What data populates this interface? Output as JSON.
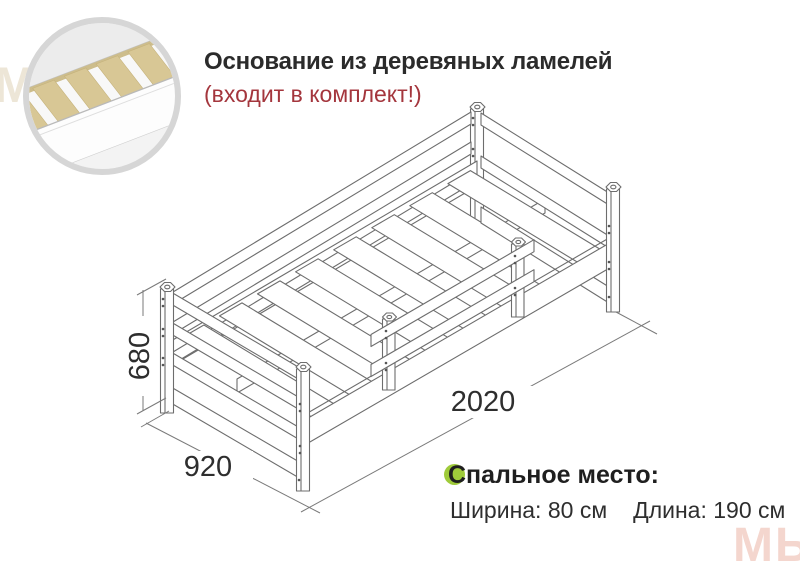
{
  "header": {
    "title": "Основание из деревяных ламелей",
    "subtitle": "(входит в комплект!)",
    "title_color": "#2b2b2b",
    "subtitle_color": "#a4363d"
  },
  "dimensions": {
    "height": "680",
    "width": "920",
    "length": "2020",
    "line_color": "#7a7a7a",
    "label_color": "#2e2e2e"
  },
  "sleeping_area": {
    "heading": "Спальное место:",
    "width_text": "Ширина: 80 см",
    "length_text": "Длина: 190 см",
    "bullet_color": "#9fcb3a"
  },
  "inset": {
    "content": "wooden-slats-closeup",
    "ring_color": "#d6d6d6",
    "slat_color": "#d8c795"
  },
  "drawing": {
    "content": "isometric-bed-frame",
    "stroke_color": "#6d6d6d"
  },
  "watermarks": {
    "top_left": "МЫ",
    "bottom_right": "МЫ"
  }
}
